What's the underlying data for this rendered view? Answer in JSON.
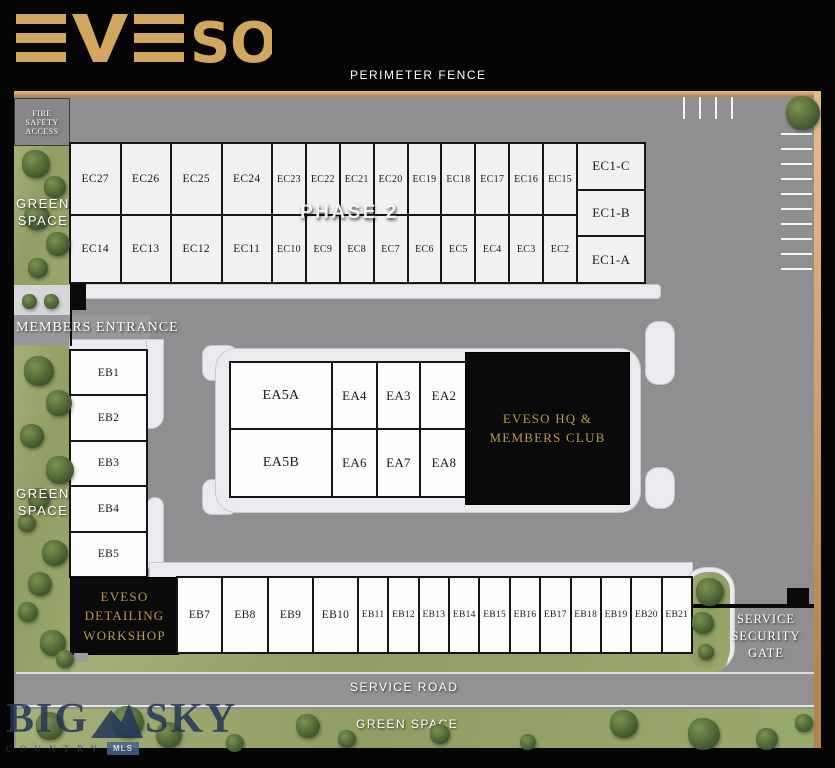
{
  "logo": {
    "text": "EVESO",
    "letters": [
      "S",
      "O"
    ]
  },
  "labels": {
    "perimeter_fence": "PERIMETER FENCE",
    "fire_safety_access": "FIRE SAFETY ACCESS",
    "green_space_top": "GREEN SPACE",
    "green_space_mid": "GREEN SPACE",
    "green_space_bottom": "GREEN SPACE",
    "members_entrance": "MEMBERS ENTRANCE",
    "phase2": "PHASE 2",
    "service_road": "SERVICE ROAD",
    "service_security_gate": "SERVICE SECURITY GATE"
  },
  "buildings": {
    "hq_label": "EVESO HQ & MEMBERS CLUB",
    "workshop_label": "EVESO DETAILING WORKSHOP"
  },
  "units": {
    "ec_top": [
      "EC27",
      "EC26",
      "EC25",
      "EC24",
      "EC23",
      "EC22",
      "EC21",
      "EC20",
      "EC19",
      "EC18",
      "EC17",
      "EC16",
      "EC15"
    ],
    "ec_bottom": [
      "EC14",
      "EC13",
      "EC12",
      "EC11",
      "EC10",
      "EC9",
      "EC8",
      "EC7",
      "EC6",
      "EC5",
      "EC4",
      "EC3",
      "EC2"
    ],
    "ec1": [
      "EC1-C",
      "EC1-B",
      "EC1-A"
    ],
    "ea_top": [
      "EA5A",
      "EA4",
      "EA3",
      "EA2"
    ],
    "ea_bottom": [
      "EA5B",
      "EA6",
      "EA7",
      "EA8"
    ],
    "eb_left": [
      "EB1",
      "EB2",
      "EB3",
      "EB4",
      "EB5"
    ],
    "eb_bottom": [
      "EB7",
      "EB8",
      "EB9",
      "EB10",
      "EB11",
      "EB12",
      "EB13",
      "EB14",
      "EB15",
      "EB16",
      "EB17",
      "EB18",
      "EB19",
      "EB20",
      "EB21"
    ]
  },
  "watermark": {
    "big": "BIG",
    "sky": "SKY",
    "country": "COUNTRY",
    "mls": "MLS"
  },
  "colors": {
    "logo_gold": "#d2a65f",
    "fence_tan": "#bd8b55",
    "road_gray": "#8f8f91",
    "sidewalk": "#e9ebee",
    "green_space": "#9aa96c",
    "building_black": "#0a0a0a",
    "building_gold_text": "#bd9751",
    "watermark_navy": "#243659",
    "mls_blue": "#45638e"
  }
}
